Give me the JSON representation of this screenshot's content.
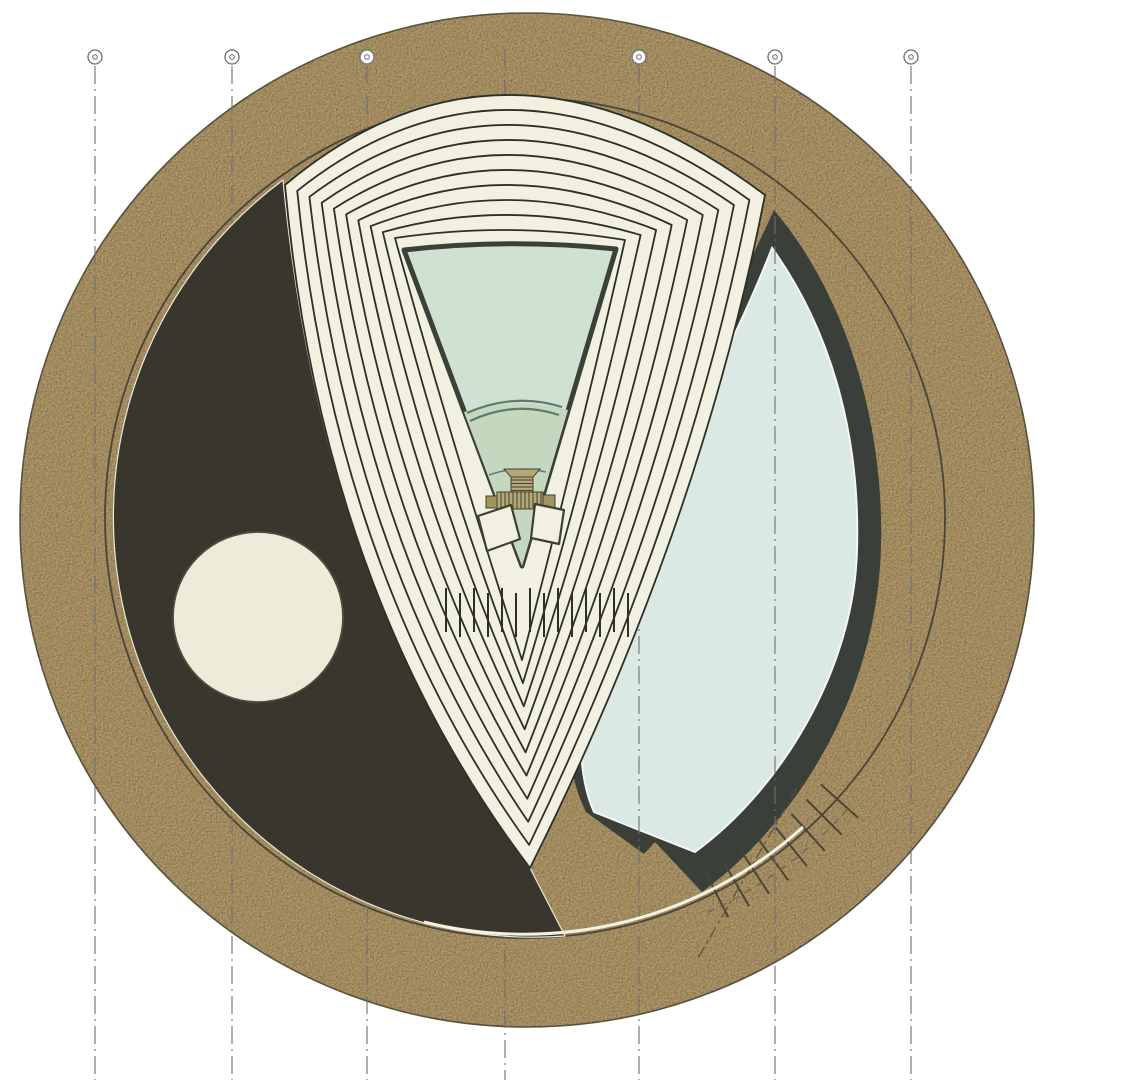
{
  "title": "Circular building plan drawing",
  "canvas": {
    "width": 1126,
    "height": 1080
  },
  "colors": {
    "background": "#ffffff",
    "tan": "#b39a6a",
    "rim": "#5e5744",
    "speckle": "#3c3114",
    "charcoal": "#39362d",
    "charcoal_edge": "#e9e7d8",
    "cream": "#f1f0e1",
    "chevron_line": "#2c3027",
    "mint_upper": "#cfe1d3",
    "mint_lower": "#c6d7bf",
    "stage_line": "#5e7a6a",
    "triangle_stroke": "#3b4136",
    "teal": "#dbe9e5",
    "teal_edge": "#f3f6f2",
    "crescent_dark": "#3a3f39",
    "khaki": "#b5a878",
    "khaki_dark": "#a2945f",
    "stripe": "#46412f",
    "grid_line": "#6f6f6f",
    "bubble_stroke": "#6f6f6f",
    "bubble_fill": "#ffffff",
    "inner_line": "#4a4537",
    "highlight": "#f3f1e3",
    "accent_fill": "#edecdb",
    "accent_stroke": "#514c3b",
    "hidden_line": "#6a654f",
    "cut_line": "#55503f"
  },
  "outer_circle": {
    "cx": 527,
    "cy": 520,
    "r": 507
  },
  "inner_circle": {
    "cx": 525,
    "cy": 518,
    "r": 420
  },
  "grid": {
    "bubble_y": 57,
    "bubble_r": 7,
    "dot_r": 2.3,
    "line_top": 66,
    "line_top_no_bubble": 50,
    "line_bottom": 1080,
    "dash": "18 5 2 5",
    "lines": [
      {
        "x": 95,
        "bubble": true
      },
      {
        "x": 232,
        "bubble": true
      },
      {
        "x": 367,
        "bubble": true
      },
      {
        "x": 505,
        "bubble": false
      },
      {
        "x": 639,
        "bubble": true
      },
      {
        "x": 775,
        "bubble": true
      },
      {
        "x": 911,
        "bubble": true
      }
    ]
  },
  "accent_circle": {
    "cx": 258,
    "cy": 617,
    "r": 85
  },
  "charcoal_path": "M283,180 Q322,594 530,868 L565,936 A420 420 0 0 1 283,180 Z",
  "crescent": {
    "dark_path": "M774,210 C850,300 884,430 881,545 C878,690 800,820 702,892 L655,842 L644,854 L586,812 C545,730 575,590 640,470 C690,380 735,295 774,210 Z",
    "fill_path": "M772,248 C838,340 860,450 857,550 C854,670 780,790 695,852 L594,812 C560,735 597,600 655,490 C700,405 740,330 772,248 Z"
  },
  "highlight_arc": "M803,827 A416 416 0 0 1 424,922",
  "hidden_arc": "M848,809 A435 435 0 0 1 702,915",
  "cut_line_path": "M797,788 L698,958",
  "stairs": {
    "cx": 525,
    "cy": 518,
    "r1": 398,
    "r2": 448,
    "start_deg": 42,
    "step_deg": 3,
    "count": 8
  },
  "fan": {
    "bands": 10,
    "L0": [
      285,
      185
    ],
    "L1": [
      395,
      238
    ],
    "CL0": [
      322,
      594
    ],
    "CL1": [
      452,
      445
    ],
    "T0": [
      530,
      868
    ],
    "T1": [
      522,
      660
    ],
    "CR0": [
      700,
      528
    ],
    "CR1": [
      578,
      446
    ],
    "R0": [
      765,
      195
    ],
    "R1": [
      625,
      240
    ],
    "CT0": [
      505,
      0
    ],
    "CT1": [
      510,
      221
    ]
  },
  "band_dashes": {
    "count": 14,
    "x0": 446,
    "step": 14,
    "y": 588,
    "len": 44
  },
  "stage": {
    "triangle_path": "M404,250 Q510,238 616,249 L522,566 Z",
    "lower_path": "M464,412 Q514,396 568,410 L522,566 Z",
    "arc_band": [
      "M470,421 Q514,400 559,415",
      "M467,413 Q514,392 562,407"
    ],
    "arc_small": "M489,475 Q517,465 546,472",
    "machine": {
      "cap_path": "M504,469 L540,469 L533,477 L511,477 Z",
      "column": {
        "x": 511,
        "y": 477,
        "w": 22,
        "h": 15
      },
      "base": {
        "x": 497,
        "y": 492,
        "w": 46,
        "h": 17
      },
      "tabs": [
        {
          "x": 486,
          "y": 496,
          "w": 11,
          "h": 12
        },
        {
          "x": 543,
          "y": 495,
          "w": 12,
          "h": 13
        }
      ]
    },
    "pads": [
      "M478,516 L511,505 L520,539 L487,551 Z",
      "M535,504 L564,510 L559,544 L531,538 Z"
    ]
  }
}
